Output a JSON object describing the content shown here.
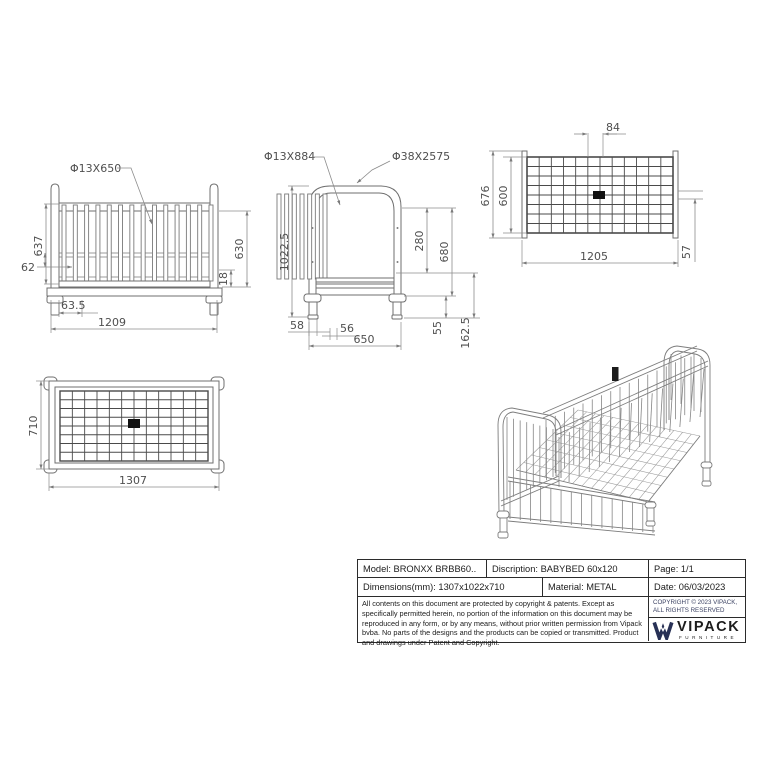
{
  "document": {
    "background": "#ffffff",
    "line_color": "#7a7a7a",
    "dim_text_color": "#4f4f4f"
  },
  "front_view": {
    "callout_bar": "Φ13X650",
    "dim_inner_height": "637",
    "dim_bar_pitch": "62",
    "dim_foot_offset": "63.5",
    "dim_width": "1209",
    "dim_side_height": "630",
    "dim_base": "18"
  },
  "side_view": {
    "callout_bar": "Φ13X884",
    "callout_tube": "Φ38X2575",
    "dim_total_height": "1022.5",
    "dim_upper": "280",
    "dim_rail_height": "680",
    "dim_leg_offset": "58",
    "dim_bar_pitch": "56",
    "dim_width": "650",
    "dim_foot_height": "55",
    "dim_base_height": "162.5"
  },
  "base_view": {
    "dim_slot": "84",
    "dim_outer_depth": "676",
    "dim_inner_depth": "600",
    "dim_width": "1205",
    "dim_offset": "57"
  },
  "top_view": {
    "dim_depth": "710",
    "dim_width": "1307"
  },
  "title_block": {
    "model": "Model: BRONXX BRBB60..",
    "description": "Discription: BABYBED 60x120",
    "page": "Page: 1/1",
    "dimensions": "Dimensions(mm): 1307x1022x710",
    "material": "Material: METAL",
    "date": "Date: 06/03/2023",
    "legal": "All contents on this document are protected by copyright & patents. Except as specifically permitted herein, no portion of the information on this document may be reproduced in any form, or by any means, without prior written permission from Vipack bvba. No parts of the designs and the products can be copied or transmitted. Product and drawings under Patent and Copyright.",
    "copyright_line1": "COPYRIGHT © 2023 VIPACK,",
    "copyright_line2": "ALL RIGHTS RESERVED",
    "brand_name": "VIPACK",
    "brand_tagline": "FURNITURE",
    "brand_navy": "#273055",
    "brand_accent": "#b5763a"
  }
}
